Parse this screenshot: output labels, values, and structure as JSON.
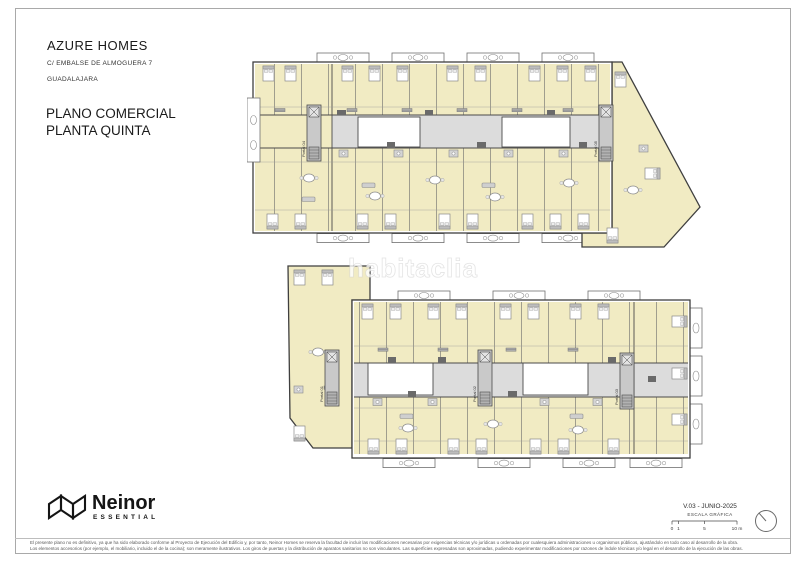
{
  "header": {
    "project": "AZURE HOMES",
    "address": "C/ EMBALSE DE ALMOGUERA 7",
    "city": "GUADALAJARA",
    "title_line1": "PLANO COMERCIAL",
    "title_line2": "PLANTA QUINTA"
  },
  "plans": {
    "top": {
      "portals": [
        "Portal 04",
        "Portal 05"
      ]
    },
    "bottom": {
      "portals": [
        "Portal 01",
        "Portal 02",
        "Portal 03"
      ]
    }
  },
  "watermark": {
    "text": "habitaclia"
  },
  "brand": {
    "name": "Neinor",
    "tagline": "ESSENTIAL"
  },
  "footer": {
    "version": "V.03 - JUNIO-2025",
    "scale_label": "ESCALA GRÁFICA",
    "scale_ticks": {
      "t0": "0",
      "t1": "1",
      "t5": "5",
      "t10": "10 m"
    },
    "disclaimer_line1": "El presente plano no es definitivo, ya que ha sido elaborado conforme al Proyecto de Ejecución del Edificio y, por tanto, Neinor Homes se reserva la facultad de incluir las modificaciones necesarias por exigencias técnicas y/o jurídicas u ordenadas por cualesquiera administraciones u organismos públicos, ajustándolo en todo caso al desarrollo de la obra.",
    "disclaimer_line2": "Los elementos accesorios (por ejemplo, el mobiliario, incluido el de la cocina); son meramente ilustrativos. Los giros de puertas y la distribución de aparatos sanitarios no son vinculantes. Las superficies expresadas son aproximadas, pudiendo experimentar modificaciones por razones de índole técnicas y/o legal en el desarrollo de la ejecución de las obras."
  },
  "colors": {
    "room_fill": "#f1ebc3",
    "corridor": "#dcdcdc",
    "wall": "#3f3f3f"
  }
}
